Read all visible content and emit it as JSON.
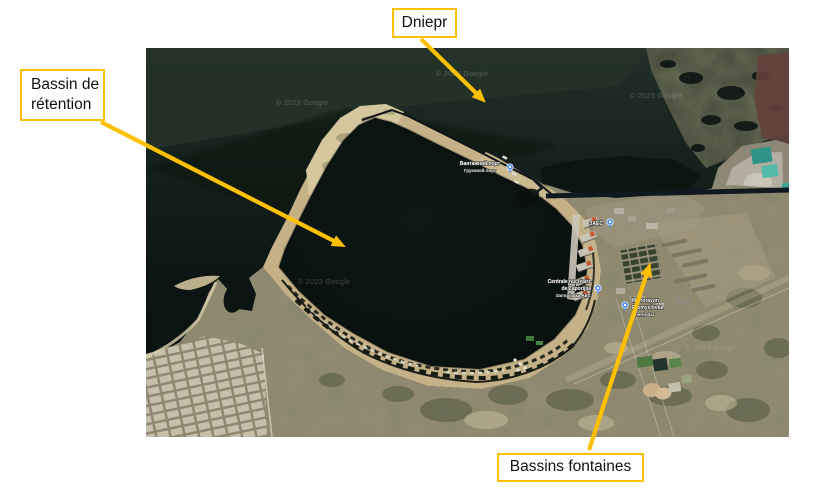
{
  "slide": {
    "background_color": "#ffffff",
    "description": "Satellite map slide of the Zaporizhzhia NPP cooling pond with three annotated callouts"
  },
  "callouts": {
    "accent_color": "#FFC000",
    "dniepr": {
      "label": "Dniepr"
    },
    "bassin_retention": {
      "line1": "Bassin de",
      "line2": "rétention"
    },
    "bassins_fontaines": {
      "label": "Bassins fontaines"
    }
  },
  "map": {
    "type": "satellite",
    "watermark": "© 2023 Google",
    "markers": [
      {
        "id": "cargo-port",
        "line1": "Вантажний порт",
        "line2": "Грузовой порт"
      },
      {
        "id": "zaes",
        "line1": "ЗАЕС"
      },
      {
        "id": "npp",
        "line1": "Centrale nucléaire",
        "line2": "de Zaporijjia",
        "line3": "Запорізька АЕС"
      },
      {
        "id": "district",
        "line1": "Mikrorayon",
        "line2": "Promyslovka",
        "line3": "Enerhodar"
      }
    ]
  }
}
